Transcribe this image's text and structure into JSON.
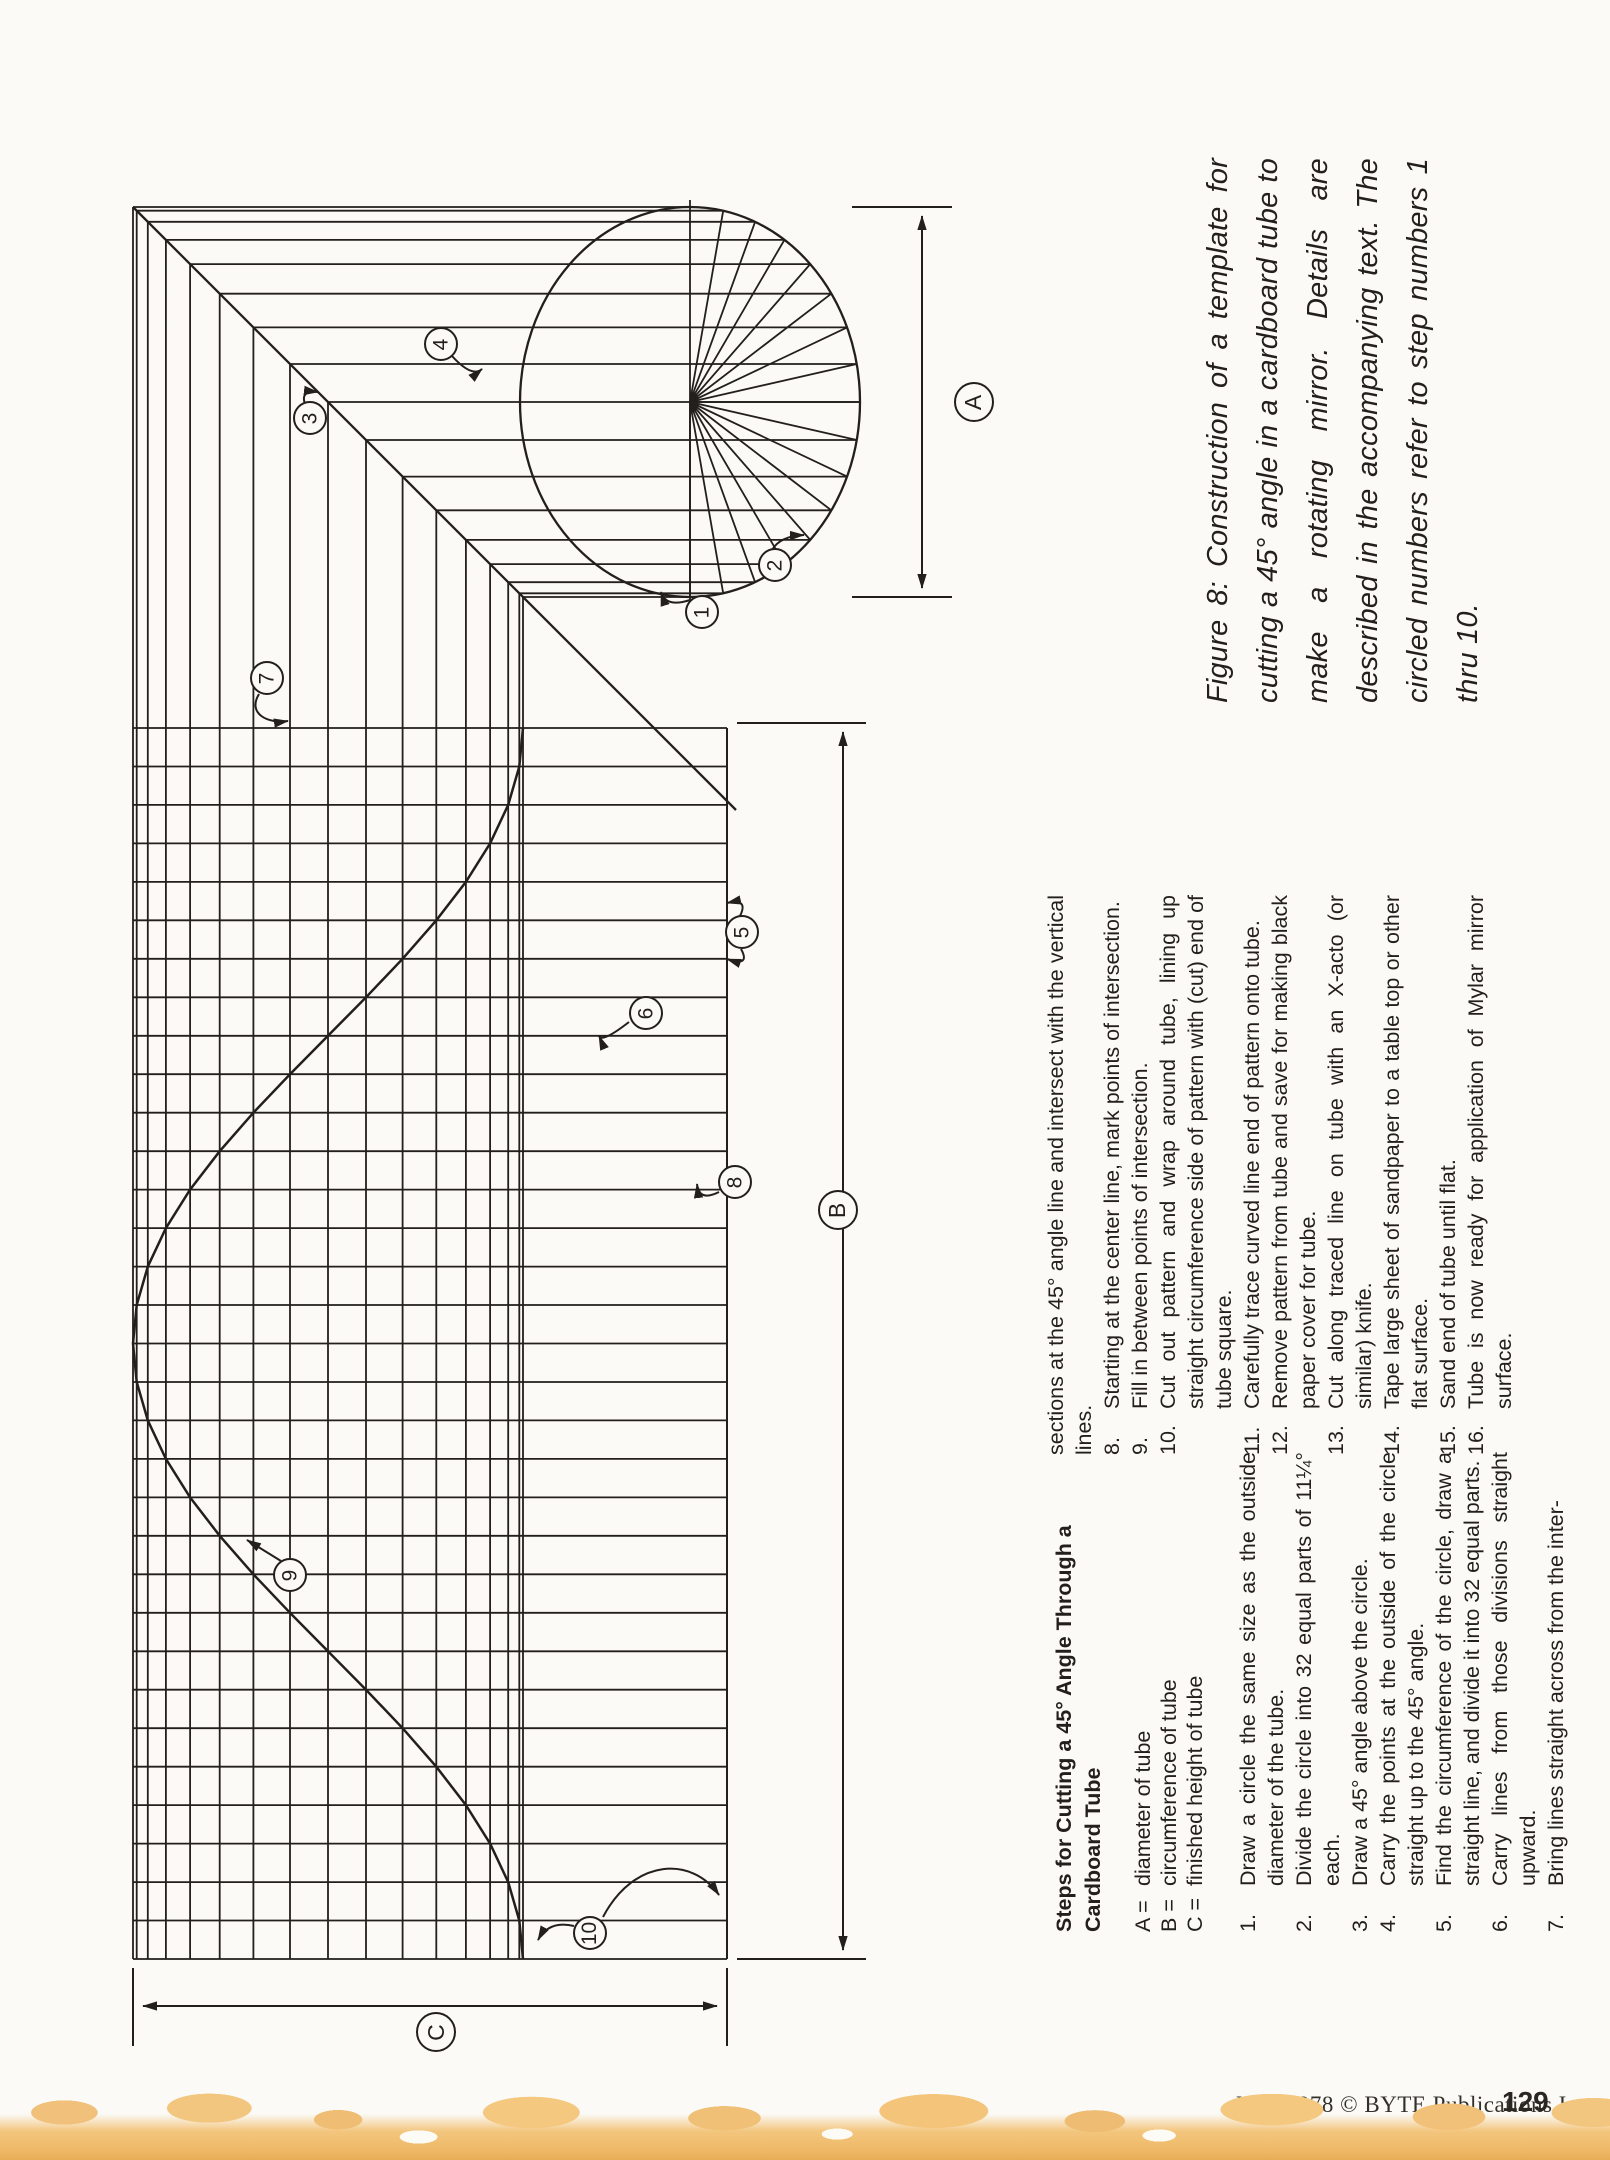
{
  "figure": {
    "caption": "Figure 8: Construction of a template for cutting a 45° angle in a cardboard tube to make a rotating mirror. Details are described in the accompanying text. The circled numbers refer to step numbers 1 thru 10."
  },
  "instructions": {
    "heading_line1": "Steps for Cutting a 45° Angle Through a",
    "heading_line2": "Cardboard Tube",
    "legend": [
      {
        "key": "A =",
        "text": "diameter of tube"
      },
      {
        "key": "B =",
        "text": "circumference of tube"
      },
      {
        "key": "C =",
        "text": "finished height of tube"
      }
    ],
    "steps_1_7": [
      {
        "num": "1.",
        "text": "Draw a circle the same size as the outside diameter of the tube."
      },
      {
        "num": "2.",
        "text": "Divide the circle into 32 equal parts of 11¼° each."
      },
      {
        "num": "3.",
        "text": "Draw a 45° angle above the circle."
      },
      {
        "num": "4.",
        "text": "Carry the points at the outside of the circle straight up to the 45° angle."
      },
      {
        "num": "5.",
        "text": "Find the circumference of the circle, draw a straight line, and divide it into 32 equal parts."
      },
      {
        "num": "6.",
        "text": "Carry lines from those divisions straight upward."
      },
      {
        "num": "7.",
        "text": "Bring lines straight across from the inter-"
      }
    ],
    "step7_runover": "sections at the 45° angle line and intersect with the vertical lines.",
    "steps_8_16": [
      {
        "num": "8.",
        "text": "Starting at the center line, mark points of intersection."
      },
      {
        "num": "9.",
        "text": "Fill in between points of intersection."
      },
      {
        "num": "10.",
        "text": "Cut out pattern and wrap around tube, lining up straight circumference side of pattern with (cut) end of tube square."
      },
      {
        "num": "11.",
        "text": "Carefully trace curved line end of pattern onto tube."
      },
      {
        "num": "12.",
        "text": "Remove pattern from tube and save for making black paper cover for tube."
      },
      {
        "num": "13.",
        "text": "Cut along traced line on tube with an X-acto (or similar) knife."
      },
      {
        "num": "14.",
        "text": "Tape large sheet of sandpaper to a table top or other flat surface."
      },
      {
        "num": "15.",
        "text": "Sand end of tube until flat."
      },
      {
        "num": "16.",
        "text": "Tube is now ready for application of Mylar mirror surface."
      }
    ]
  },
  "diagram": {
    "callouts": [
      {
        "label": "1"
      },
      {
        "label": "2"
      },
      {
        "label": "3"
      },
      {
        "label": "4"
      },
      {
        "label": "5"
      },
      {
        "label": "6"
      },
      {
        "label": "7"
      },
      {
        "label": "8"
      },
      {
        "label": "9"
      },
      {
        "label": "10"
      }
    ],
    "dims": [
      {
        "label": "A"
      },
      {
        "label": "B"
      },
      {
        "label": "C"
      }
    ]
  },
  "footer": {
    "credit": "May 1978 © BYTE Publications Inc",
    "page_number": "129"
  },
  "colors": {
    "ink": "#221f1c",
    "paper": "#fbfaf6",
    "scan_band": "#f3c67e"
  }
}
